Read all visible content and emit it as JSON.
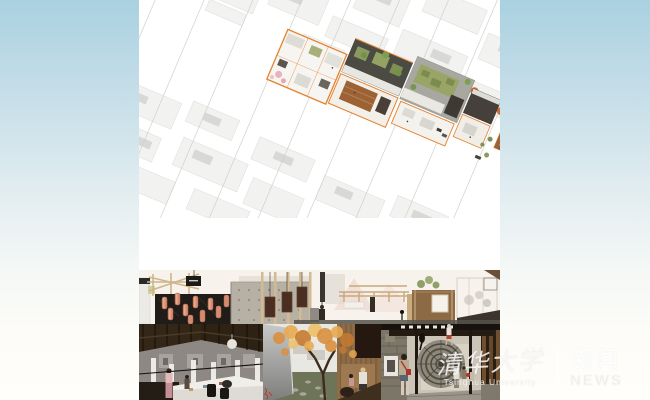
{
  "watermark": {
    "university_zh": "清华大学",
    "university_en": "Tsinghua University",
    "separator_bar": "|",
    "news_zh": "新闻",
    "news_en": "NEWS"
  },
  "colors": {
    "background_top": "#a9d1e0",
    "background_bottom": "#fffefa",
    "panel_white": "#ffffff",
    "plan_accent_orange": "#e5822e",
    "plan_roof_dark": "#4b4b43",
    "plan_courtyard_green": "#8b9a5e",
    "plan_wall_brown": "#8a5a35",
    "city_fabric_gray": "#f2f2f0",
    "lantern_salmon": "#d68a70",
    "wood_tan": "#cfb48d",
    "autumn_foliage": "#d98f3f",
    "stone_gray": "#7c7668",
    "watermark_white": "#ffffff"
  }
}
